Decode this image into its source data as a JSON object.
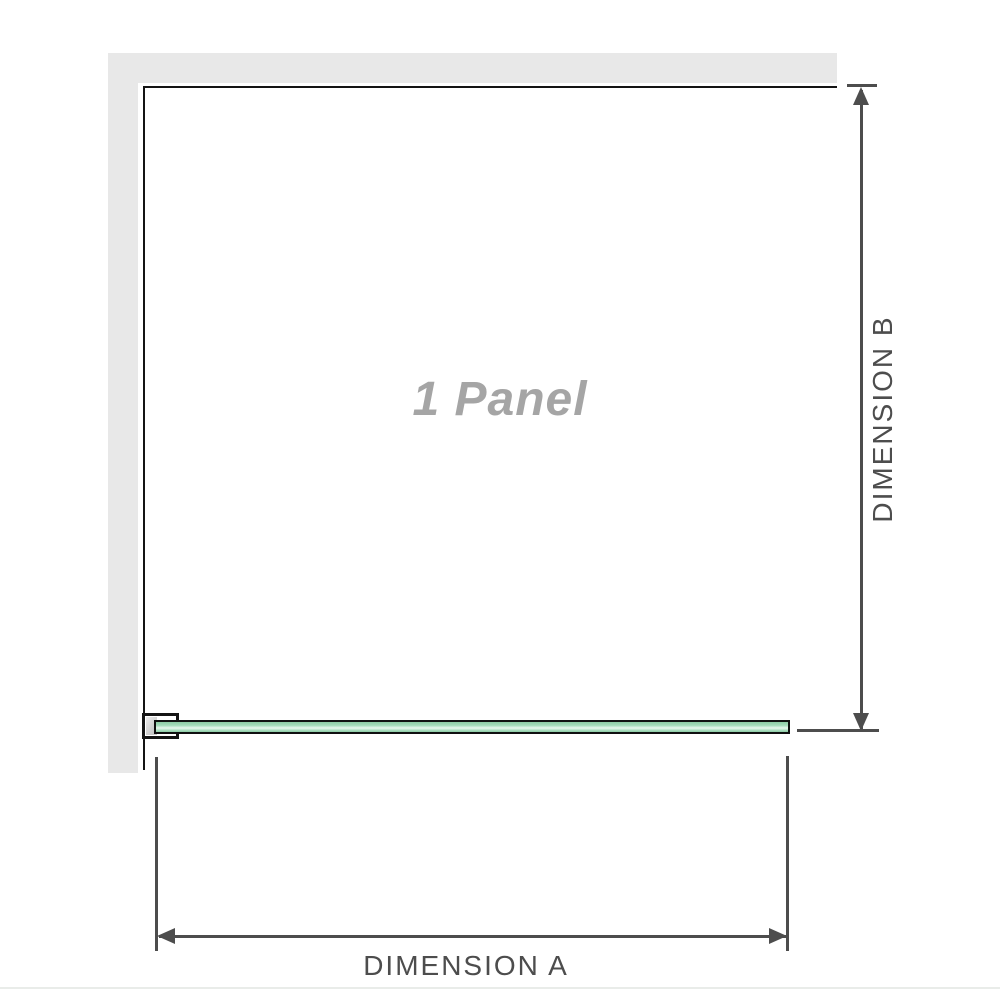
{
  "diagram": {
    "panel_label": "1 Panel",
    "dimension_a": {
      "label": "DIMENSION A"
    },
    "dimension_b": {
      "label": "DIMENSION B"
    }
  },
  "colors": {
    "wall": "#e8e8e8",
    "outline": "#141414",
    "dim": "#4d4d4d",
    "panel_text": "#a5a5a5",
    "glass_dark": "#8ccaa4",
    "glass_mid": "#a6dcbb",
    "glass_light": "#e9f7ee",
    "glass_border": "#101010",
    "bracket_shade": "#c6c6c6",
    "separator": "#e9ece9"
  }
}
